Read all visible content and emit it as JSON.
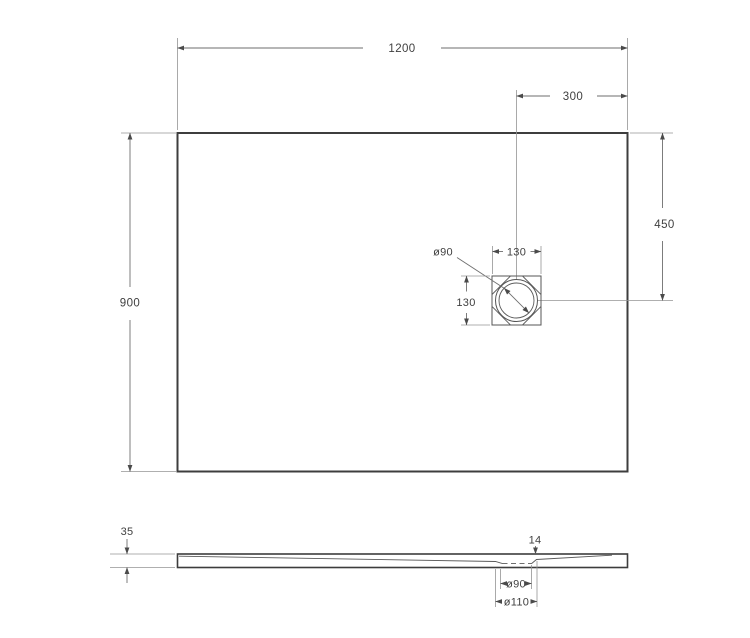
{
  "drawing": {
    "subject": "shower-tray-technical-drawing",
    "views": {
      "top_view": {
        "width": "1200",
        "height": "900",
        "drain_offset_from_right": "300",
        "drain_offset_from_top": "450",
        "drain_frame_width": "130",
        "drain_frame_height": "130",
        "drain_diameter": "ø90"
      },
      "side_view": {
        "edge_thickness": "35",
        "drain_zone_thickness": "14",
        "drain_hole_diameter": "ø90",
        "drain_recess_diameter": "ø110"
      }
    },
    "colors": {
      "outline": "#3d3d3d",
      "dimension_line": "#6e6e6e",
      "extension_line": "#949494",
      "text": "#3f3f3f",
      "background": "#ffffff"
    }
  }
}
